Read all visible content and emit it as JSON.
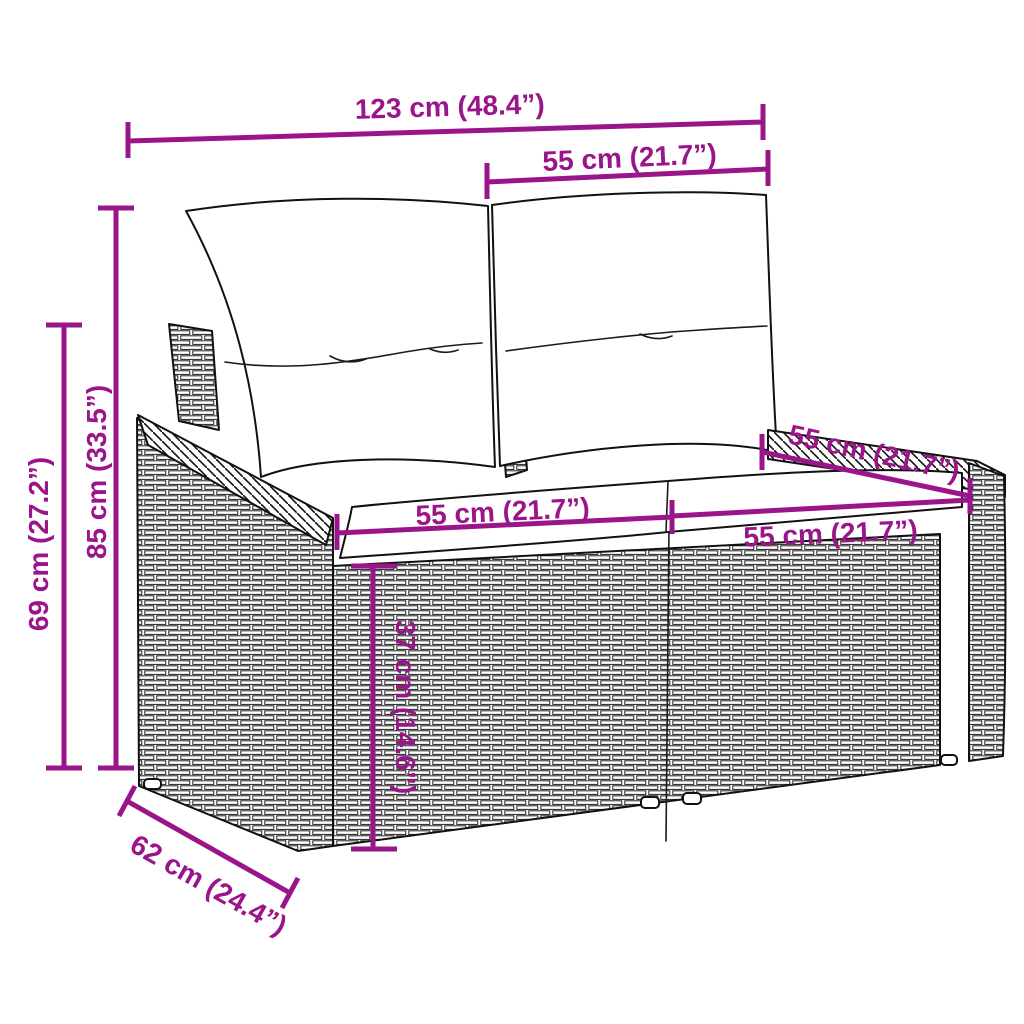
{
  "diagram": {
    "subject": "rattan-garden-bench-with-cushions",
    "view": "front-left perspective line art with dimension annotations"
  },
  "colors": {
    "dimension": "#9A148A",
    "line_art": "#111111",
    "background": "#ffffff",
    "cushion_fill": "#ffffff"
  },
  "dimensions": {
    "total_width": {
      "label": "123 cm (48.4”)"
    },
    "back_width_right": {
      "label": "55 cm (21.7”)"
    },
    "height_total": {
      "label": "85 cm (33.5”)"
    },
    "height_arm": {
      "label": "69 cm (27.2”)"
    },
    "seat_depth": {
      "label": "55 cm (21.7”)"
    },
    "seat_width_left": {
      "label": "55 cm (21.7”)"
    },
    "seat_width_right": {
      "label": "55 cm (21.7”)"
    },
    "seat_height": {
      "label": "37 cm (14.6”)"
    },
    "base_depth": {
      "label": "62 cm (24.4”)"
    }
  }
}
